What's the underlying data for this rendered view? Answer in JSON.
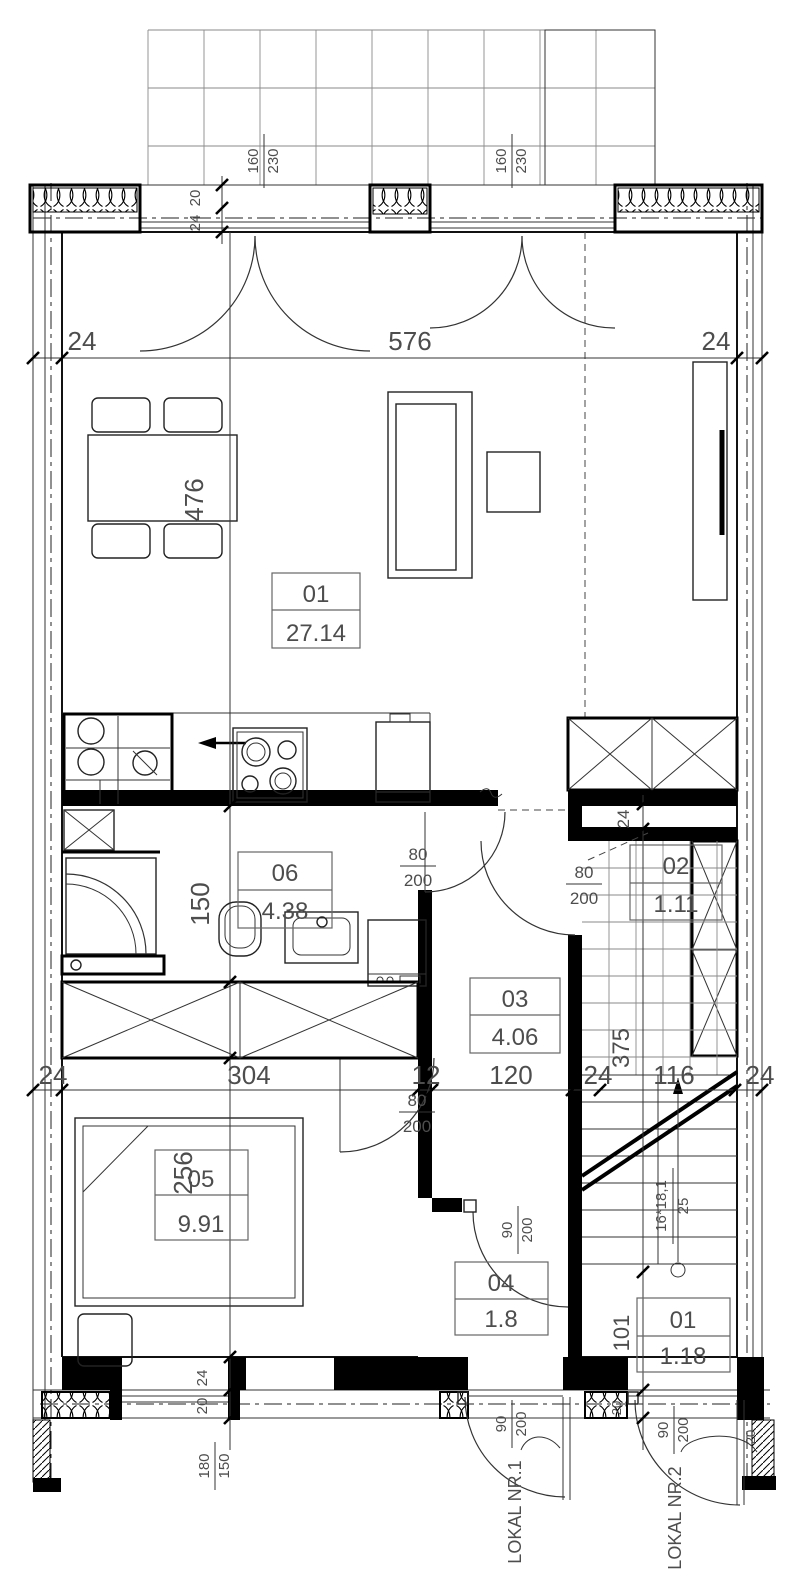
{
  "rooms": [
    {
      "id": "01",
      "area": "27.14"
    },
    {
      "id": "06",
      "area": "4.38"
    },
    {
      "id": "02",
      "area": "1.11"
    },
    {
      "id": "03",
      "area": "4.06"
    },
    {
      "id": "05",
      "area": "9.91"
    },
    {
      "id": "04",
      "area": "1.8"
    },
    {
      "id": "01",
      "area": "1.18"
    }
  ],
  "dims": {
    "top": [
      "24",
      "576",
      "24"
    ],
    "middle": [
      "24",
      "304",
      "12",
      "120",
      "24",
      "116",
      "24"
    ],
    "left": {
      "living": "476",
      "bathroom": "150",
      "bedroom": "256",
      "wall": "24",
      "insulation": "20"
    },
    "right": {
      "shaft": "24",
      "stair_run": "375",
      "vestibule": "101",
      "wall_top": "20",
      "wall_bottom": "20"
    },
    "top_wall": {
      "insulation": "20",
      "masonry": "24"
    },
    "window": {
      "width": "180",
      "height": "150"
    }
  },
  "doors": {
    "terrace_left": {
      "width": "160",
      "height": "230"
    },
    "terrace_right": {
      "width": "160",
      "height": "230"
    },
    "bathroom": {
      "width": "80",
      "height": "200"
    },
    "storage": {
      "width": "80",
      "height": "200"
    },
    "bedroom": {
      "width": "80",
      "height": "200"
    },
    "vestibule": {
      "width": "90",
      "height": "200"
    },
    "entrance_unit1": {
      "width": "90",
      "height": "200"
    },
    "entrance_unit2": {
      "width": "90",
      "height": "200"
    }
  },
  "stairs": {
    "risers": "16*18,1",
    "tread": "25"
  },
  "units": {
    "unit1": "LOKAL NR.1",
    "unit2": "LOKAL NR.2"
  }
}
